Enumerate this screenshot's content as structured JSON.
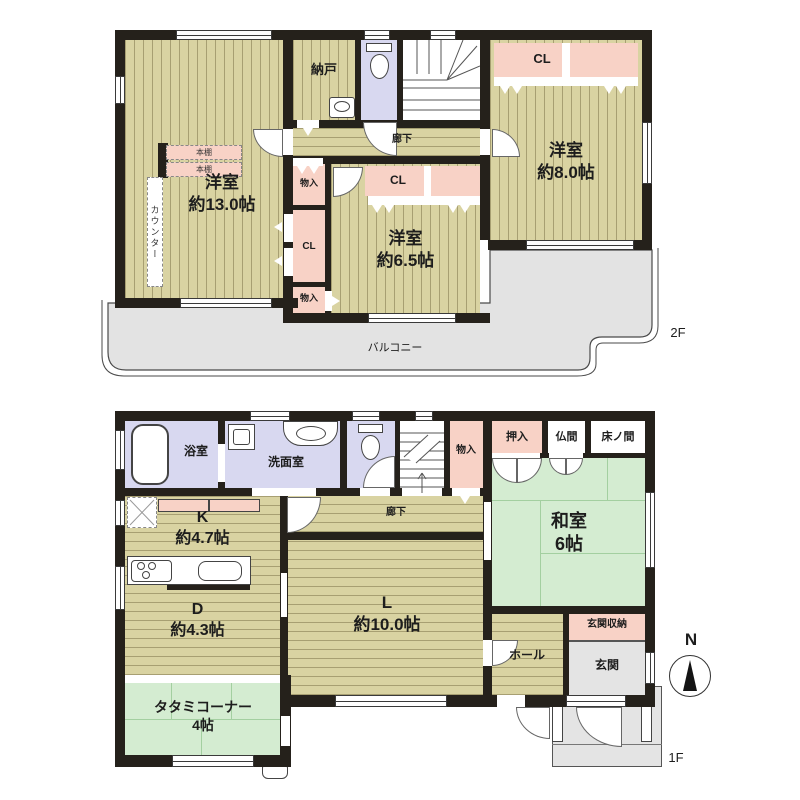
{
  "f2": {
    "floor_tag": "2F",
    "room13": {
      "name": "洋室",
      "size": "約13.0帖"
    },
    "room65": {
      "name": "洋室",
      "size": "約6.5帖"
    },
    "room80": {
      "name": "洋室",
      "size": "約8.0帖"
    },
    "nando": "納戸",
    "corridor": "廊下",
    "closet": "CL",
    "storage": "物入",
    "counter": "カウンター",
    "bookshelf": "本棚",
    "balcony": "バルコニー"
  },
  "f1": {
    "floor_tag": "1F",
    "bath": "浴室",
    "washroom": "洗面室",
    "kitchen": {
      "name": "K",
      "size": "約4.7帖"
    },
    "dining": {
      "name": "D",
      "size": "約4.3帖"
    },
    "living": {
      "name": "L",
      "size": "約10.0帖"
    },
    "washitsu": {
      "name": "和室",
      "size": "6帖"
    },
    "tatami_corner": {
      "name": "タタミコーナー",
      "size": "4帖"
    },
    "corridor": "廊下",
    "storage": "物入",
    "oshiire": "押入",
    "butsuma": "仏間",
    "tokonoma": "床ノ間",
    "hall": "ホール",
    "genkan": "玄関",
    "genkan_storage": "玄関収納"
  },
  "compass": {
    "north": "N"
  }
}
